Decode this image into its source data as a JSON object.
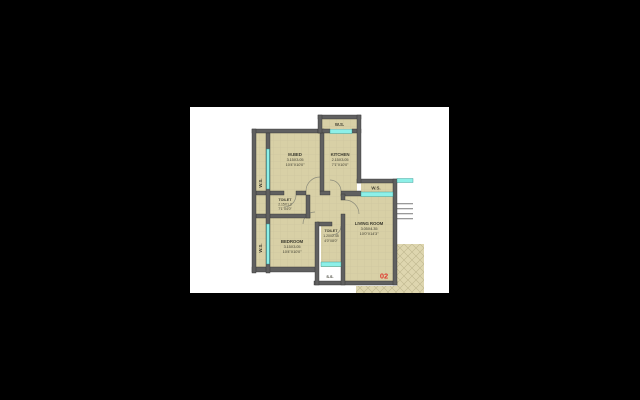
{
  "plan": {
    "unit_number": "02",
    "washing_space_label": "W.S.",
    "service_shaft_label": "S.S.",
    "rooms": {
      "mbed": {
        "name": "M.BED",
        "dim_m": "3.15X3.05",
        "dim_ft": "10'4\"X10'0\""
      },
      "kitchen": {
        "name": "KITCHEN",
        "dim_m": "2.15X3.05",
        "dim_ft": "7'1\"X10'0\""
      },
      "toilet1": {
        "name": "TOILET",
        "dim_m": "2.15X1.2",
        "dim_ft": "7'1\"X4'0\""
      },
      "toilet2": {
        "name": "TOILET",
        "dim_m": "1.20X2.45",
        "dim_ft": "4'0\"X8'0\""
      },
      "bedroom": {
        "name": "BEDROOM",
        "dim_m": "3.15X3.05",
        "dim_ft": "10'4\"X10'0\""
      },
      "living": {
        "name": "LIVING ROOM",
        "dim_m": "3.05X4.35",
        "dim_ft": "10'0\"X14'3\""
      }
    },
    "colors": {
      "background": "#000000",
      "canvas": "#ffffff",
      "floor": "#d8d0a6",
      "wall": "#606060",
      "window": "#8df0e8",
      "accent_red": "#e0392e"
    }
  }
}
